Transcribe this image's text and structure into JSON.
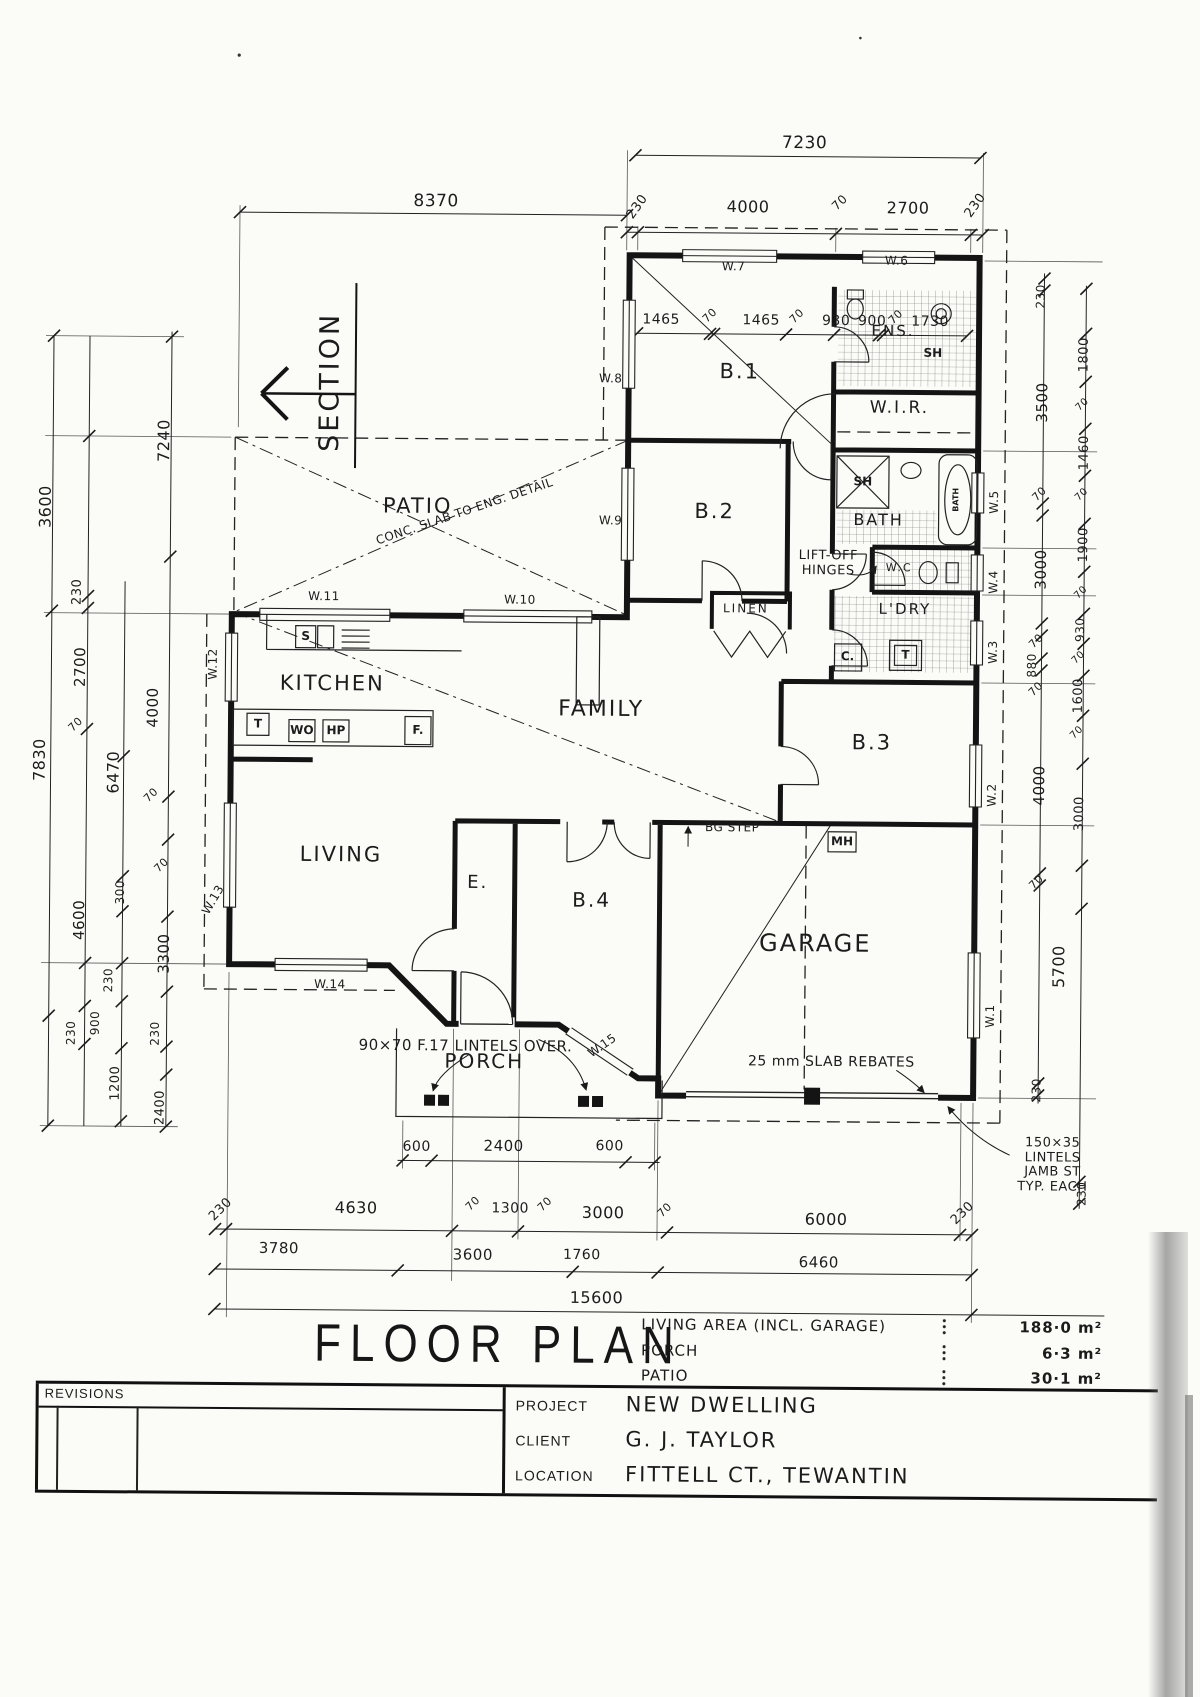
{
  "drawing": {
    "title": "FLOOR PLAN",
    "section_label": "SECTION",
    "rooms": [
      {
        "t": "PATIO",
        "x": 415,
        "y": 508,
        "s": 21
      },
      {
        "t": "KITCHEN",
        "x": 331,
        "y": 686,
        "s": 21
      },
      {
        "t": "FAMILY",
        "x": 600,
        "y": 710,
        "s": 22
      },
      {
        "t": "LIVING",
        "x": 341,
        "y": 857,
        "s": 21
      },
      {
        "t": "B.1",
        "x": 736,
        "y": 371,
        "s": 21
      },
      {
        "t": "B.2",
        "x": 712,
        "y": 511,
        "s": 21
      },
      {
        "t": "B.3",
        "x": 871,
        "y": 741,
        "s": 21
      },
      {
        "t": "B.4",
        "x": 592,
        "y": 900,
        "s": 20
      },
      {
        "t": "GARAGE",
        "x": 816,
        "y": 942,
        "s": 24
      },
      {
        "t": "PORCH",
        "x": 486,
        "y": 1062,
        "s": 20
      },
      {
        "t": "E.",
        "x": 478,
        "y": 884,
        "s": 18
      },
      {
        "t": "ENS.",
        "x": 889,
        "y": 329,
        "s": 15
      },
      {
        "t": "W.I.R.",
        "x": 896,
        "y": 406,
        "s": 17
      },
      {
        "t": "BATH",
        "x": 876,
        "y": 518,
        "s": 16
      },
      {
        "t": "W.C",
        "x": 897,
        "y": 566,
        "s": 11
      },
      {
        "t": "L'DRY",
        "x": 903,
        "y": 607,
        "s": 15
      },
      {
        "t": "LINEN",
        "x": 744,
        "y": 608,
        "s": 12
      }
    ],
    "window_tags": [
      {
        "t": "W.7",
        "x": 729,
        "y": 266
      },
      {
        "t": "W.6",
        "x": 892,
        "y": 259
      },
      {
        "t": "W.8",
        "x": 607,
        "y": 379
      },
      {
        "t": "W.9",
        "x": 608,
        "y": 521
      },
      {
        "t": "W.10",
        "x": 518,
        "y": 601
      },
      {
        "t": "W.11",
        "x": 322,
        "y": 599
      },
      {
        "t": "W.12",
        "x": 212,
        "y": 667,
        "r": -90
      },
      {
        "t": "W.13",
        "x": 214,
        "y": 903,
        "r": -60
      },
      {
        "t": "W.14",
        "x": 331,
        "y": 987
      },
      {
        "t": "W.15",
        "x": 604,
        "y": 1046,
        "r": -35
      },
      {
        "t": "W.5",
        "x": 992,
        "y": 499,
        "r": -90
      },
      {
        "t": "W.4",
        "x": 992,
        "y": 579,
        "r": -90
      },
      {
        "t": "W.3",
        "x": 992,
        "y": 649,
        "r": -90
      },
      {
        "t": "W.2",
        "x": 992,
        "y": 792,
        "r": -90
      },
      {
        "t": "W.1",
        "x": 992,
        "y": 1013,
        "r": -90
      }
    ],
    "fixtures": [
      {
        "t": "S",
        "x": 304,
        "y": 639
      },
      {
        "t": "T",
        "x": 257,
        "y": 727
      },
      {
        "t": "WO",
        "x": 301,
        "y": 733
      },
      {
        "t": "HP",
        "x": 335,
        "y": 733
      },
      {
        "t": "F.",
        "x": 417,
        "y": 732
      },
      {
        "t": "C.",
        "x": 846,
        "y": 655
      },
      {
        "t": "T",
        "x": 904,
        "y": 653
      },
      {
        "t": "SH",
        "x": 860,
        "y": 480
      },
      {
        "t": "SH",
        "x": 929,
        "y": 351
      },
      {
        "t": "MH",
        "x": 842,
        "y": 840
      },
      {
        "t": "BATH",
        "x": 954,
        "y": 497,
        "r": -90,
        "s": 8
      }
    ],
    "notes": [
      {
        "t": "CONC. SLAB TO ENG. DETAIL",
        "x": 462,
        "y": 513,
        "r": -19,
        "s": 12
      },
      {
        "t": "LIFT-OFF\nHINGES",
        "x": 826,
        "y": 562,
        "s": 13
      },
      {
        "t": "BG STEP",
        "x": 732,
        "y": 827,
        "s": 12
      },
      {
        "t": "90×70 F.17 LINTELS OVER.",
        "x": 467,
        "y": 1047,
        "s": 15
      },
      {
        "t": "25 mm SLAB REBATES",
        "x": 833,
        "y": 1061,
        "s": 14
      },
      {
        "t": "150×35\nLINTELS\nJAMB ST\nTYP. EACH",
        "x": 1055,
        "y": 1162,
        "s": 13
      }
    ],
    "dim_labels": [
      {
        "t": "7230",
        "x": 799,
        "y": 142,
        "s": 17
      },
      {
        "t": "230",
        "x": 633,
        "y": 207,
        "r": -55,
        "s": 13
      },
      {
        "t": "4000",
        "x": 743,
        "y": 206,
        "s": 16
      },
      {
        "t": "70",
        "x": 835,
        "y": 201,
        "r": -45,
        "s": 12
      },
      {
        "t": "2700",
        "x": 903,
        "y": 206,
        "s": 16
      },
      {
        "t": "230",
        "x": 971,
        "y": 203,
        "r": -55,
        "s": 13
      },
      {
        "t": "1465",
        "x": 657,
        "y": 320,
        "s": 14
      },
      {
        "t": "70",
        "x": 706,
        "y": 315,
        "r": -45,
        "s": 11
      },
      {
        "t": "1465",
        "x": 757,
        "y": 320,
        "s": 14
      },
      {
        "t": "70",
        "x": 793,
        "y": 315,
        "r": -45,
        "s": 11
      },
      {
        "t": "930",
        "x": 832,
        "y": 320,
        "s": 14
      },
      {
        "t": "900",
        "x": 868,
        "y": 320,
        "s": 14
      },
      {
        "t": "70",
        "x": 892,
        "y": 315,
        "r": -45,
        "s": 11
      },
      {
        "t": "1730",
        "x": 926,
        "y": 320,
        "s": 14
      },
      {
        "t": "8370",
        "x": 431,
        "y": 203,
        "s": 17
      },
      {
        "t": "7240",
        "x": 161,
        "y": 444,
        "r": -90,
        "s": 16
      },
      {
        "t": "3600",
        "x": 43,
        "y": 511,
        "r": -90,
        "s": 16
      },
      {
        "t": "230",
        "x": 76,
        "y": 596,
        "r": -90,
        "s": 13
      },
      {
        "t": "2700",
        "x": 79,
        "y": 671,
        "r": -90,
        "s": 15
      },
      {
        "t": "70",
        "x": 75,
        "y": 729,
        "r": -45,
        "s": 11
      },
      {
        "t": "7830",
        "x": 39,
        "y": 764,
        "r": -90,
        "s": 16
      },
      {
        "t": "4000",
        "x": 152,
        "y": 711,
        "r": -90,
        "s": 15
      },
      {
        "t": "6470",
        "x": 113,
        "y": 776,
        "r": -90,
        "s": 16
      },
      {
        "t": "70",
        "x": 151,
        "y": 799,
        "r": -45,
        "s": 11
      },
      {
        "t": "4600",
        "x": 80,
        "y": 924,
        "r": -90,
        "s": 15
      },
      {
        "t": "70",
        "x": 162,
        "y": 869,
        "r": -45,
        "s": 11
      },
      {
        "t": "3300",
        "x": 165,
        "y": 957,
        "r": -90,
        "s": 15
      },
      {
        "t": "300",
        "x": 121,
        "y": 896,
        "r": -90,
        "s": 12
      },
      {
        "t": "230",
        "x": 110,
        "y": 984,
        "r": -90,
        "s": 12
      },
      {
        "t": "900",
        "x": 97,
        "y": 1027,
        "r": -90,
        "s": 12
      },
      {
        "t": "230",
        "x": 73,
        "y": 1037,
        "r": -90,
        "s": 12
      },
      {
        "t": "230",
        "x": 157,
        "y": 1037,
        "r": -90,
        "s": 12
      },
      {
        "t": "1200",
        "x": 118,
        "y": 1087,
        "r": -90,
        "s": 13
      },
      {
        "t": "2400",
        "x": 163,
        "y": 1111,
        "r": -90,
        "s": 13
      },
      {
        "t": "230",
        "x": 1037,
        "y": 293,
        "r": -90,
        "s": 12
      },
      {
        "t": "3500",
        "x": 1039,
        "y": 399,
        "r": -90,
        "s": 15
      },
      {
        "t": "70",
        "x": 1037,
        "y": 491,
        "r": -45,
        "s": 11
      },
      {
        "t": "3000",
        "x": 1039,
        "y": 566,
        "r": -90,
        "s": 15
      },
      {
        "t": "70",
        "x": 1035,
        "y": 638,
        "r": -45,
        "s": 11
      },
      {
        "t": "880",
        "x": 1031,
        "y": 662,
        "r": -90,
        "s": 12
      },
      {
        "t": "70",
        "x": 1035,
        "y": 686,
        "r": -45,
        "s": 11
      },
      {
        "t": "4000",
        "x": 1039,
        "y": 782,
        "r": -90,
        "s": 15
      },
      {
        "t": "70",
        "x": 1037,
        "y": 879,
        "r": -45,
        "s": 11
      },
      {
        "t": "5700",
        "x": 1060,
        "y": 963,
        "r": -90,
        "s": 16
      },
      {
        "t": "230",
        "x": 1039,
        "y": 1087,
        "r": -90,
        "s": 12
      },
      {
        "t": "1800",
        "x": 1081,
        "y": 351,
        "r": -90,
        "s": 13
      },
      {
        "t": "70",
        "x": 1079,
        "y": 401,
        "r": -45,
        "s": 10
      },
      {
        "t": "1460",
        "x": 1082,
        "y": 449,
        "r": -90,
        "s": 13
      },
      {
        "t": "70",
        "x": 1079,
        "y": 491,
        "r": -45,
        "s": 10
      },
      {
        "t": "1900",
        "x": 1082,
        "y": 541,
        "r": -90,
        "s": 13
      },
      {
        "t": "70",
        "x": 1079,
        "y": 589,
        "r": -45,
        "s": 10
      },
      {
        "t": "930",
        "x": 1079,
        "y": 626,
        "r": -90,
        "s": 12
      },
      {
        "t": "70",
        "x": 1077,
        "y": 654,
        "r": -45,
        "s": 10
      },
      {
        "t": "1600",
        "x": 1078,
        "y": 692,
        "r": -90,
        "s": 13
      },
      {
        "t": "70",
        "x": 1076,
        "y": 729,
        "r": -45,
        "s": 10
      },
      {
        "t": "3000",
        "x": 1080,
        "y": 810,
        "r": -90,
        "s": 13
      },
      {
        "t": "230",
        "x": 1085,
        "y": 1190,
        "r": -90,
        "s": 12
      },
      {
        "t": "600",
        "x": 419,
        "y": 1149,
        "s": 14
      },
      {
        "t": "2400",
        "x": 506,
        "y": 1147,
        "s": 15
      },
      {
        "t": "600",
        "x": 612,
        "y": 1147,
        "s": 14
      },
      {
        "t": "230",
        "x": 224,
        "y": 1213,
        "r": -45,
        "s": 13
      },
      {
        "t": "4630",
        "x": 359,
        "y": 1210,
        "s": 16
      },
      {
        "t": "70",
        "x": 476,
        "y": 1205,
        "r": -45,
        "s": 11
      },
      {
        "t": "1300",
        "x": 513,
        "y": 1210,
        "s": 14
      },
      {
        "t": "70",
        "x": 548,
        "y": 1205,
        "r": -45,
        "s": 11
      },
      {
        "t": "3000",
        "x": 606,
        "y": 1213,
        "s": 16
      },
      {
        "t": "70",
        "x": 668,
        "y": 1210,
        "r": -45,
        "s": 11
      },
      {
        "t": "6000",
        "x": 829,
        "y": 1218,
        "s": 16
      },
      {
        "t": "230",
        "x": 966,
        "y": 1211,
        "r": -45,
        "s": 13
      },
      {
        "t": "3780",
        "x": 282,
        "y": 1251,
        "s": 15
      },
      {
        "t": "3600",
        "x": 476,
        "y": 1256,
        "s": 15
      },
      {
        "t": "1760",
        "x": 585,
        "y": 1256,
        "s": 14
      },
      {
        "t": "6460",
        "x": 822,
        "y": 1261,
        "s": 15
      },
      {
        "t": "15600",
        "x": 600,
        "y": 1298,
        "s": 16
      }
    ]
  },
  "summary": {
    "rows": [
      {
        "label": "LIVING AREA (INCL. GARAGE)",
        "value": "188·0 m²"
      },
      {
        "label": "PORCH",
        "value": "6·3 m²"
      },
      {
        "label": "PATIO",
        "value": "30·1 m²"
      }
    ]
  },
  "title_block": {
    "revisions_label": "REVISIONS",
    "fields": [
      {
        "label": "PROJECT",
        "value": "NEW DWELLING"
      },
      {
        "label": "CLIENT",
        "value": "G. J. TAYLOR"
      },
      {
        "label": "LOCATION",
        "value": "FITTELL CT., TEWANTIN"
      }
    ]
  }
}
